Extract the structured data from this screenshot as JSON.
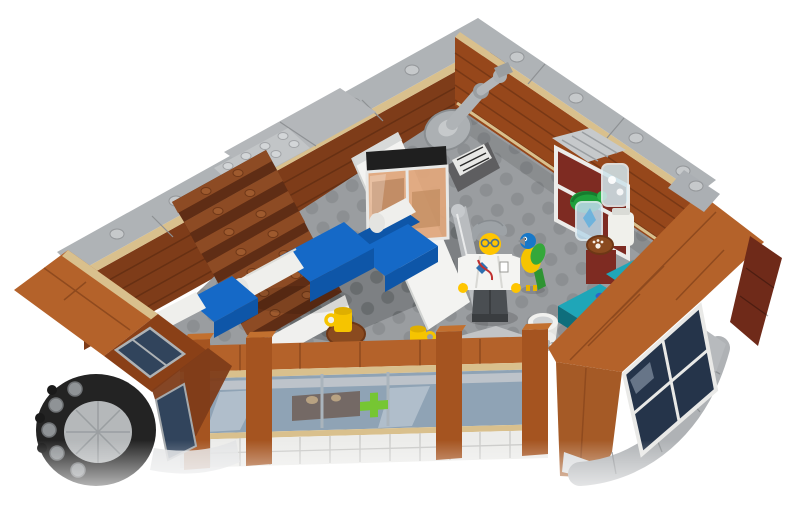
{
  "scene": {
    "type": "product-photo",
    "subject": "LEGO corner building interior, top-down three-quarter view, open floor with minifigure",
    "background": "#FFFFFF",
    "objects": [
      {
        "name": "back-left-wall",
        "desc": "reddish-brown interior wall with light gray coping and studs"
      },
      {
        "name": "back-right-wall",
        "desc": "reddish-brown interior wall with light gray coping and tan baseboard"
      },
      {
        "name": "staircase",
        "desc": "reddish-brown brick stairs descending from gray landing"
      },
      {
        "name": "floor",
        "desc": "gray studded baseplate floor with darker plate band"
      },
      {
        "name": "robot-arm-statue",
        "desc": "gray articulated arm sculpture on pedestal in back corner"
      },
      {
        "name": "partition-wall",
        "desc": "white interior partition with gray rail and amber display tank"
      },
      {
        "name": "sofa",
        "desc": "blue sofa with white roll cushion"
      },
      {
        "name": "bench-seat",
        "desc": "second blue seat with white roll cushion"
      },
      {
        "name": "armchair",
        "desc": "blue armchair with white roll cushion beside tank"
      },
      {
        "name": "side-table",
        "desc": "round brown table with yellow mug"
      },
      {
        "name": "mug",
        "desc": "yellow mug on floor"
      },
      {
        "name": "vet-minifigure",
        "desc": "minifigure with gray hair, glasses, white lab coat, dark gray legs"
      },
      {
        "name": "parrot",
        "desc": "blue/green/yellow parrot standing on floor"
      },
      {
        "name": "pet-bowl",
        "desc": "white cylinder bowl with chrome part"
      },
      {
        "name": "exam-table",
        "desc": "dark turquoise table pieces"
      },
      {
        "name": "display-shelf",
        "desc": "white cage shelf with green turtle, canisters, jar, paw-print dish on dark red pedestal"
      },
      {
        "name": "right-wall",
        "desc": "bright orange-brown exterior wall band with window and curved gray bay"
      },
      {
        "name": "front-wall",
        "desc": "orange-brown facade with window band, green cross decal, tan trim, white tile base"
      },
      {
        "name": "left-wing-wall",
        "desc": "orange-brown wall with dark windows"
      },
      {
        "name": "corner-turret",
        "desc": "black ring turret top with gray round studs and gray dome"
      }
    ]
  },
  "palette": {
    "background": "#FFFFFF",
    "coping_gray": "#AFB3B6",
    "landing_gray": "#C2C5C7",
    "wall_brown_left": "#7E3C19",
    "wall_brown_right": "#96471B",
    "ext_orange": "#B4622A",
    "ext_orange_dark": "#A55A26",
    "trim_tan": "#D9C08D",
    "floor_gray": "#9A9DA0",
    "floor_gray_dark": "#7D8083",
    "floor_light_strip": "#C2C4C6",
    "stair_top": "#8D4B24",
    "stair_front": "#5F2D15",
    "sofa_blue": "#1569C7",
    "sofa_blue_dark": "#0E56A8",
    "cushion_white": "#EFEFEC",
    "partition_white": "#F3F3F1",
    "tank_amber": "#DFA77C",
    "desk_teal": "#1FA6B8",
    "desk_teal_dark": "#11808F",
    "mug_yellow": "#F6C400",
    "turret_black": "#232323",
    "window_glass_dark": "#31445C",
    "window_glass_front": "#8FA3B5",
    "window_navy": "#25344A",
    "cross_green": "#76C633",
    "minifig_yellow": "#FFC500",
    "hair_gray": "#9DA2A6",
    "legs_gray": "#4A4E52",
    "parrot_blue": "#1878C8",
    "parrot_green": "#34A83A",
    "turtle_green": "#1FA03C",
    "shelf_dark_red": "#7E2B22",
    "statue_gray": "#ACB0B3",
    "table_brown": "#8A4A1F",
    "tile_white": "#ECECEA",
    "maroon_wall": "#6F2A19"
  }
}
